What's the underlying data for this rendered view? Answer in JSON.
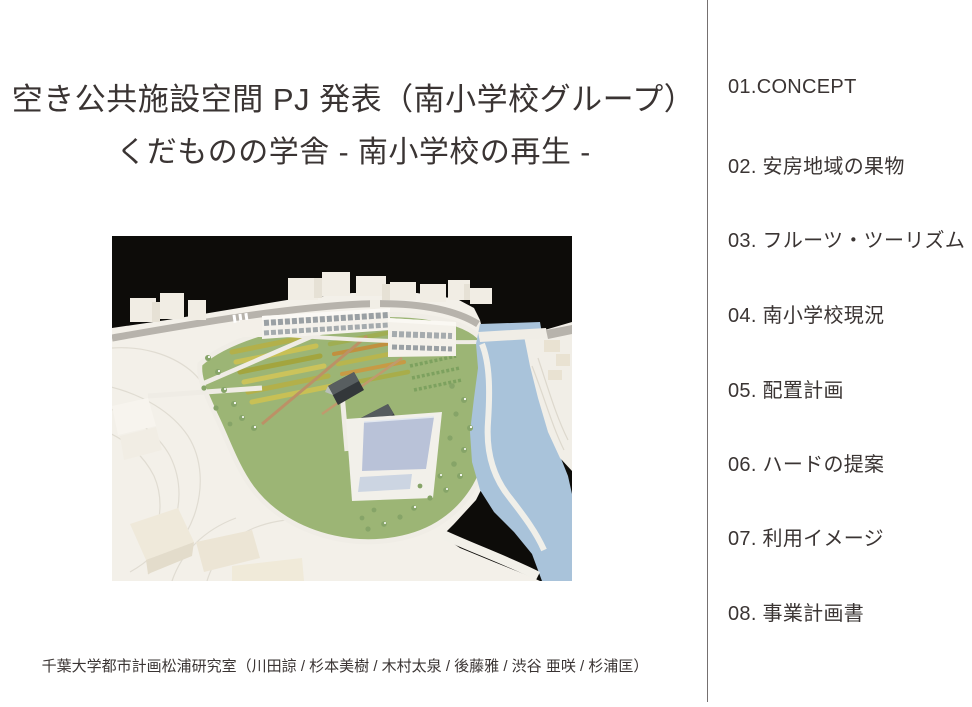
{
  "slide": {
    "title": "空き公共施設空間 PJ 発表（南小学校グループ）",
    "subtitle": "くだものの学舎 - 南小学校の再生 -",
    "credit": "千葉大学都市計画松浦研究室（川田諒 / 杉本美樹 / 木村太泉 / 後藤雅 / 渋谷 亜咲 / 杉浦匡）"
  },
  "agenda": {
    "items": [
      "01.CONCEPT",
      "02. 安房地域の果物",
      "03. フルーツ・ツーリズム",
      "04. 南小学校現況",
      "05. 配置計画",
      "06. ハードの提案",
      "07. 利用イメージ",
      "08. 事業計画書"
    ]
  },
  "photo": {
    "alt": "Photograph of a white architectural site model against a black background: terraced terrain, school buildings, yellow-green orchard rows, two dark barns, a pale blue pool, scattered trees and a light blue river curving along the right side"
  },
  "colors": {
    "background": "#ffffff",
    "text": "#3a3433",
    "divider": "#757070",
    "photo_sky": "#0d0c09",
    "photo_terrain": "#f3f0e9",
    "photo_grass": "#9cb575",
    "photo_river": "#a9c3da",
    "photo_pool": "#b9c2d8"
  }
}
